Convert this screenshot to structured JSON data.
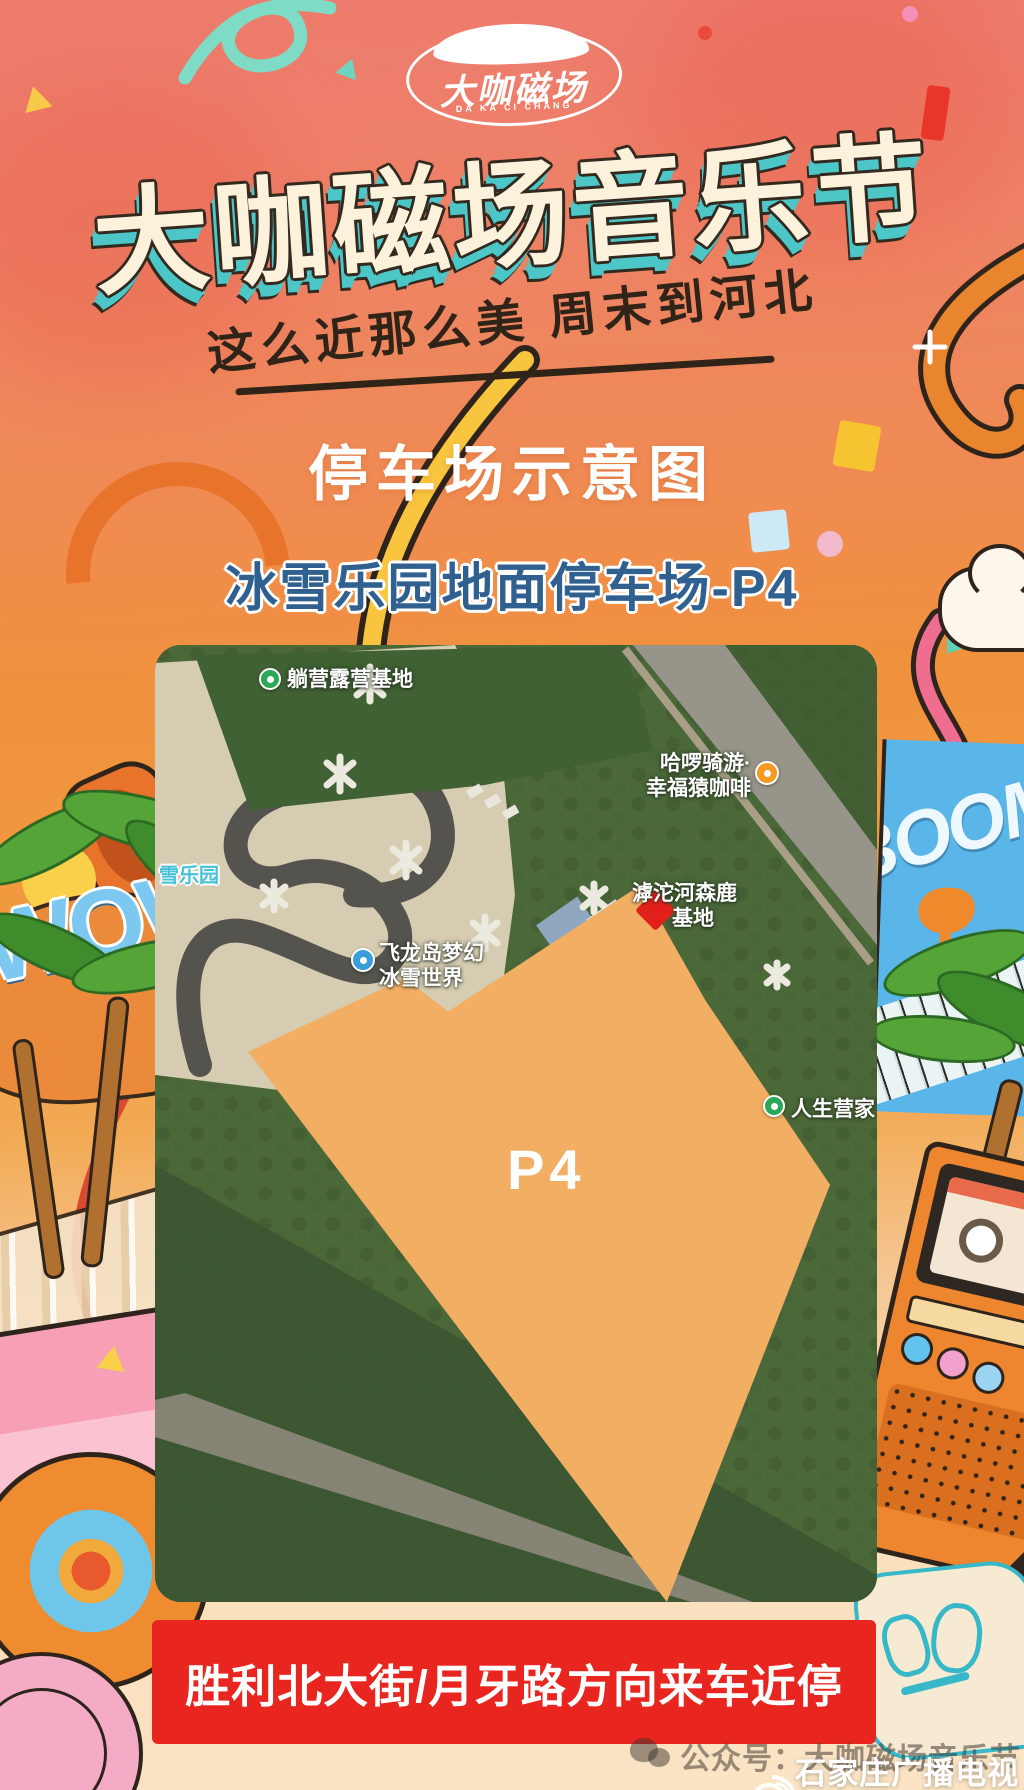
{
  "poster": {
    "logo": {
      "name": "大咖磁场",
      "latin": "DA KA CI CHANG"
    },
    "title": "大咖磁场音乐节",
    "subtitle": "这么近那么美 周末到河北",
    "section_title": "停车场示意图",
    "lot_title": "冰雪乐园地面停车场-P4",
    "banner_text": "胜利北大街/月牙路方向来车近停",
    "footer": {
      "account": "公众号：大咖磁场音乐节",
      "watermark": "石家庄广播电视台"
    }
  },
  "map": {
    "parking_label": "P4",
    "labels": {
      "camp": {
        "text": "躺营露营基地"
      },
      "coffee": {
        "line1": "哈啰骑游·",
        "line2": "幸福猿咖啡"
      },
      "deer": {
        "line1": "滹沱河森鹿",
        "line2": "基地"
      },
      "ice": {
        "line1": "飞龙岛梦幻",
        "line2": "冰雪世界"
      },
      "life": {
        "text": "人生营家"
      },
      "snow": {
        "text": "雪乐园"
      }
    }
  },
  "decor": {
    "boom": "BOOM",
    "wow": "WOW",
    "music_note": "♪"
  },
  "colors": {
    "banner_red": "#E8251F",
    "parking_orange": "#F2AE63",
    "title_fill": "#FCF1DB",
    "title_extrude": "#4CC6C6",
    "lot_blue": "#30608F",
    "bg_top": "#ED7B6E",
    "bg_orange": "#F0913D",
    "bg_cream": "#FAE4C4",
    "marker_red": "#E2201B"
  }
}
